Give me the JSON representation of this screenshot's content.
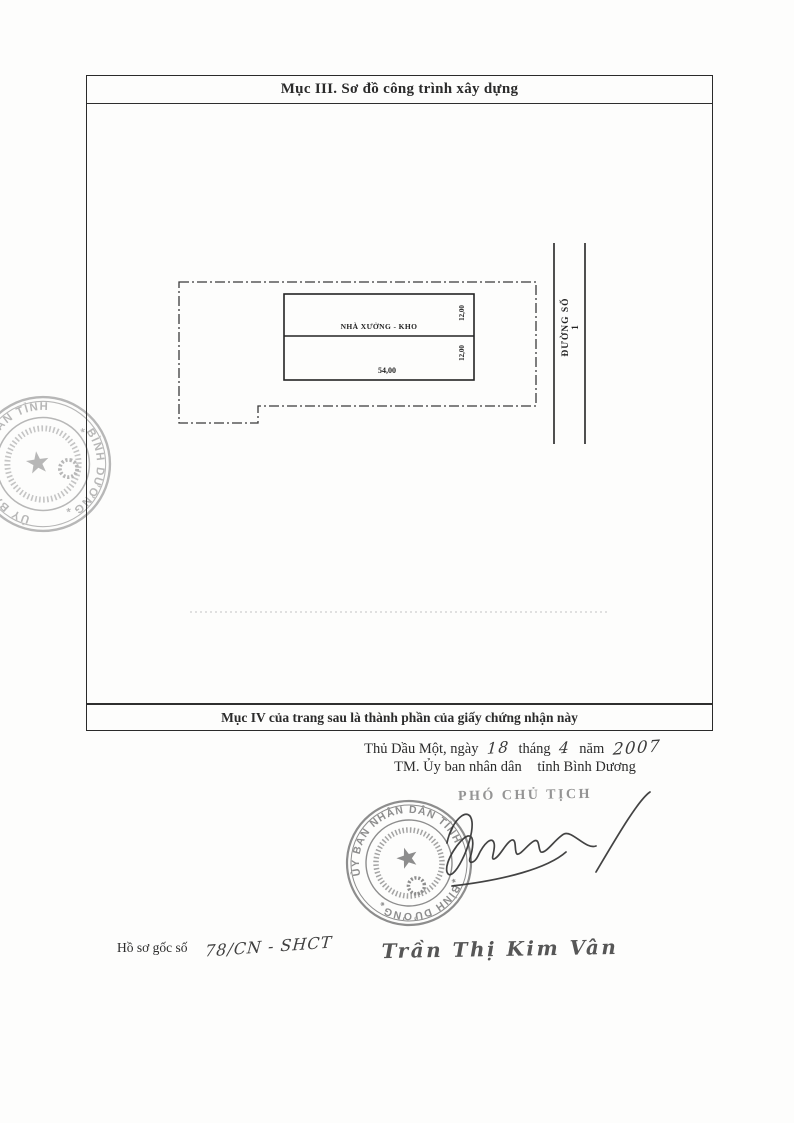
{
  "document": {
    "section_title": "Mục III. Sơ đồ công trình xây dựng",
    "footer_note": "Mục IV của trang sau là thành phần của giấy chứng nhận này"
  },
  "diagram": {
    "building_label": "NHÀ XƯỞNG - KHO",
    "dim_width_top": "12,00",
    "dim_width_bottom": "12,00",
    "dim_length": "54,00",
    "road_label": "ĐƯỜNG SỐ 1"
  },
  "signing": {
    "place": "Thủ Dầu Một",
    "day_label": ", ngày",
    "day": "18",
    "month_label": "tháng",
    "month": "4",
    "year_label": "năm",
    "year": "2007",
    "on_behalf": "TM. Ủy ban nhân dân",
    "province": "tỉnh Bình Dương",
    "signer_title": "PHÓ CHỦ TỊCH",
    "signer_name": "Trần Thị Kim Vân"
  },
  "dossier": {
    "label": "Hồ sơ gốc số",
    "number": "78/CN - SHCT"
  },
  "seal": {
    "arc_top": "ỦY BAN NHÂN DÂN TỈNH",
    "arc_bottom": "BÌNH DƯƠNG",
    "star": "*"
  },
  "colors": {
    "ink": "#2b2b2b",
    "seal_gray": "#8d8d8d",
    "faded_gray": "#949494"
  }
}
